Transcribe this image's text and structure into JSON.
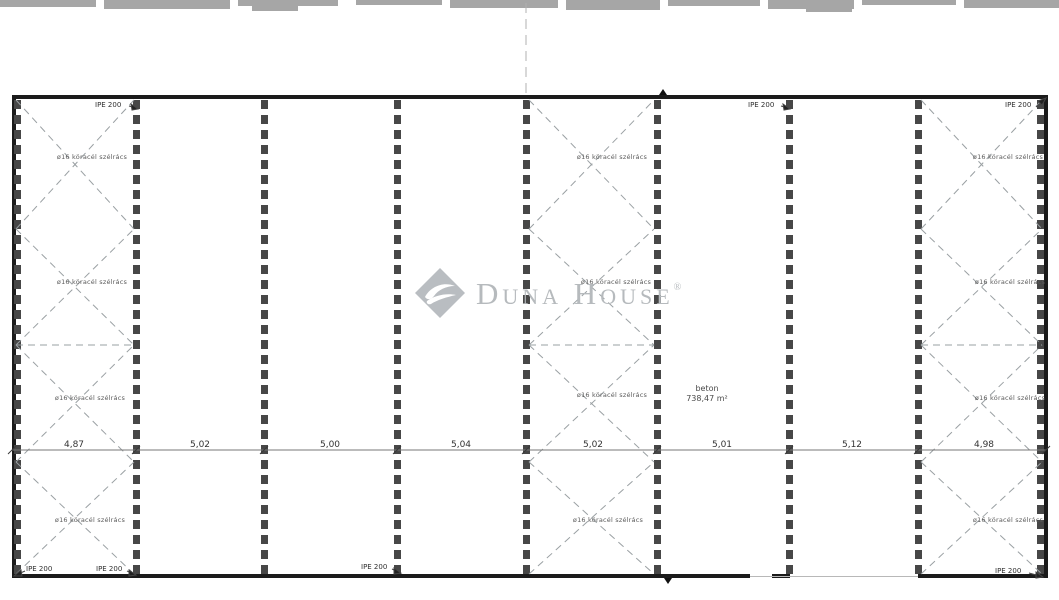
{
  "labels": {
    "beam": "IPE 200",
    "bracing": "ø16 köracél szélrács",
    "area_line1": "beton",
    "area_line2": "738,47 m²"
  },
  "dims": [
    "4,87",
    "5,02",
    "5,00",
    "5,04",
    "5,02",
    "5,01",
    "5,12",
    "4,98"
  ],
  "watermark": {
    "name": "Duna House",
    "registered": "®"
  },
  "colors": {
    "wall": "#1b1b1b",
    "column_strip": "#474747",
    "bracing_dash": "#9aa0a3",
    "dimension_line": "#777777",
    "watermark_gray": "#b6babd"
  }
}
